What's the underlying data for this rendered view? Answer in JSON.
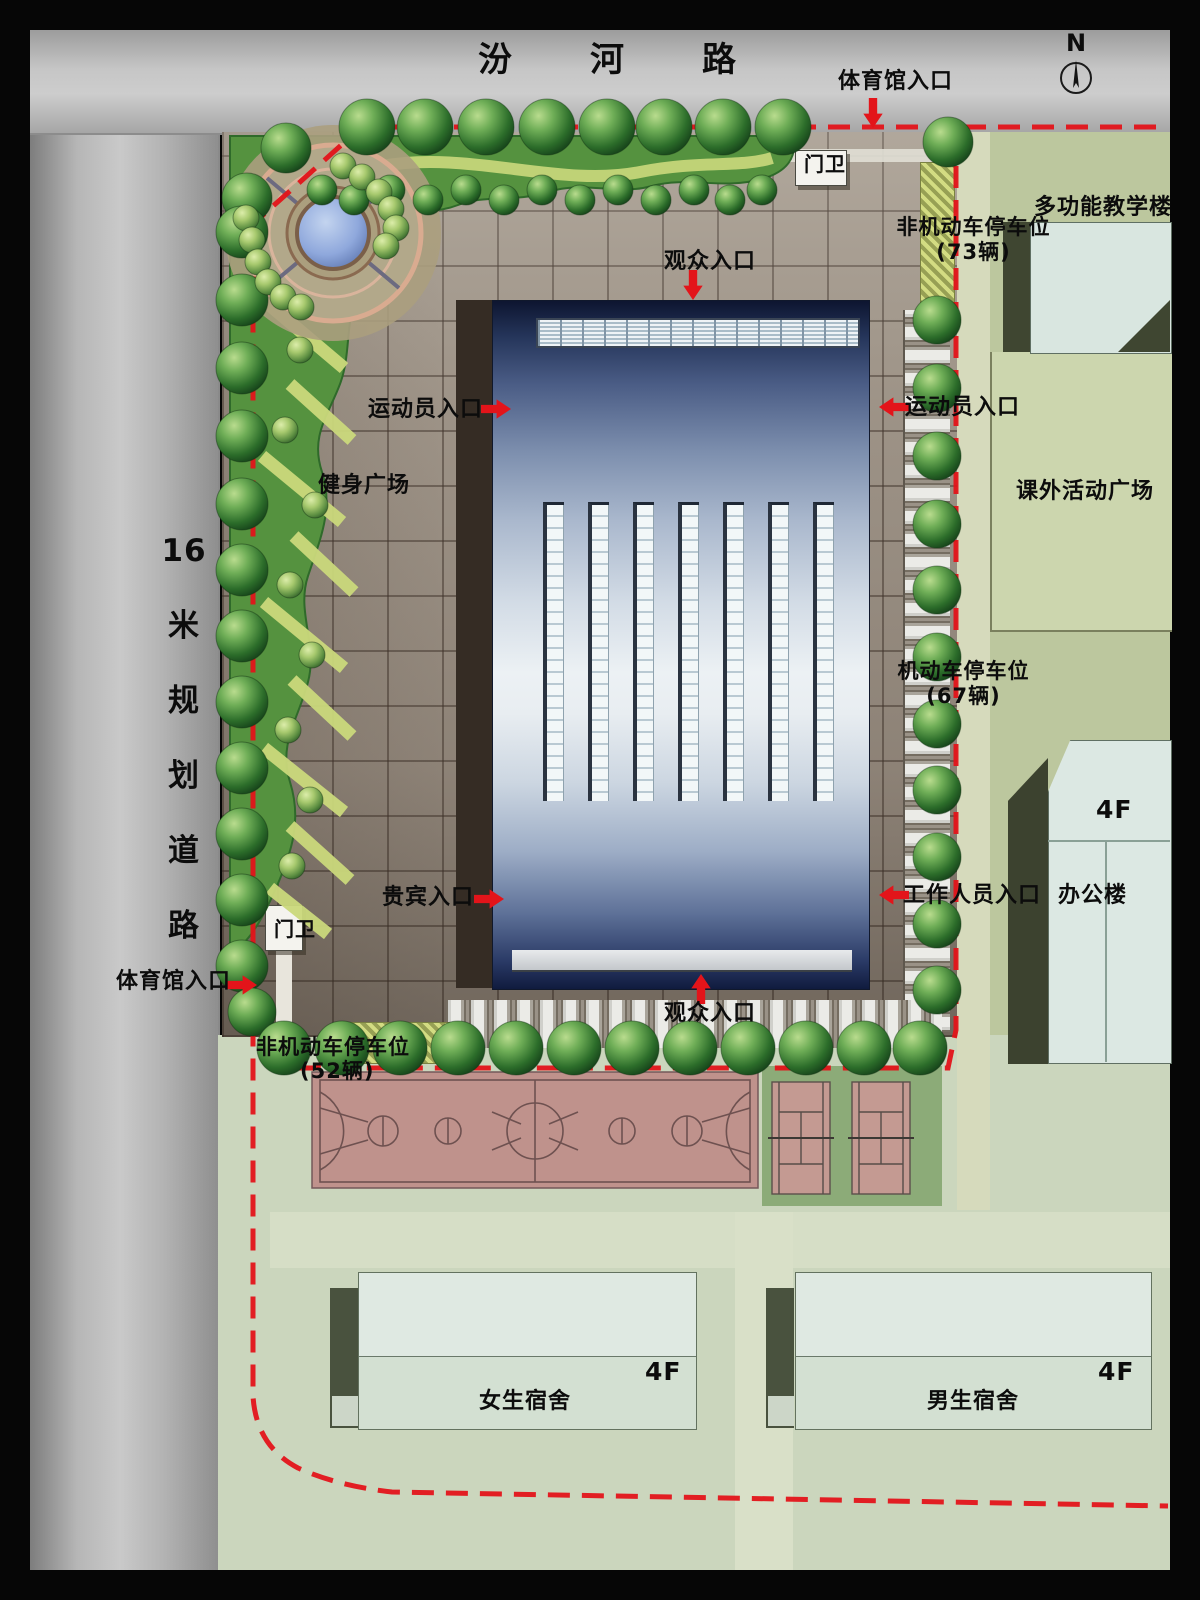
{
  "plan": {
    "road_top": "汾河路",
    "road_left_chars": [
      "16",
      "米",
      "规",
      "划",
      "道",
      "路"
    ],
    "north": "N",
    "labels": {
      "gym_entrance": "体育馆入口",
      "gate": "门卫",
      "spectator": "观众入口",
      "athlete": "运动员入口",
      "vip": "贵宾入口",
      "staff": "工作人员入口",
      "fitness_plaza": "健身广场",
      "activity_plaza": "课外活动广场",
      "teaching_building": "多功能教学楼",
      "office_building": "办公楼",
      "girls_dorm": "女生宿舍",
      "boys_dorm": "男生宿舍",
      "floors": "4F",
      "bike_parking": "非机动车停车位",
      "bike_count_right": "(73辆)",
      "bike_count_left": "(52辆)",
      "car_parking": "机动车停车位",
      "car_count": "(67辆)"
    },
    "colors": {
      "boundary": "#e3141a",
      "landscape": "#55923f",
      "pond": "#8fa8dc",
      "court": "#bf928c",
      "building_navy": "#1a2547"
    }
  }
}
